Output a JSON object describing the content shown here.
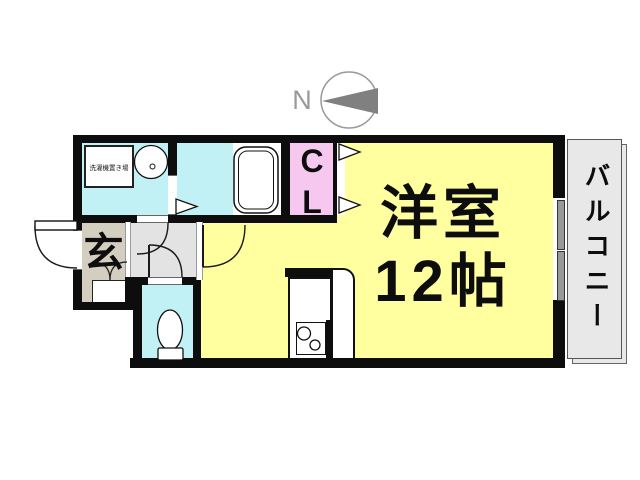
{
  "compass": {
    "label": "N"
  },
  "rooms": {
    "main": {
      "name": "洋室",
      "size": "12帖"
    },
    "closet": {
      "label": "CL"
    },
    "balcony": {
      "label": "バルコニー"
    },
    "entrance": {
      "label": "玄"
    },
    "washroom": {
      "laundry_label": "洗濯機置き場"
    }
  },
  "colors": {
    "room_main": "#FFFFA0",
    "wet_rooms": "#C2F1F5",
    "closet": "#F6C8F0",
    "entrance": "#D4CEC0",
    "hallway": "#E3E3E3",
    "balcony": "#E8E8E8",
    "wall": "#0D0D0D",
    "compass_arrow": "#808080"
  }
}
